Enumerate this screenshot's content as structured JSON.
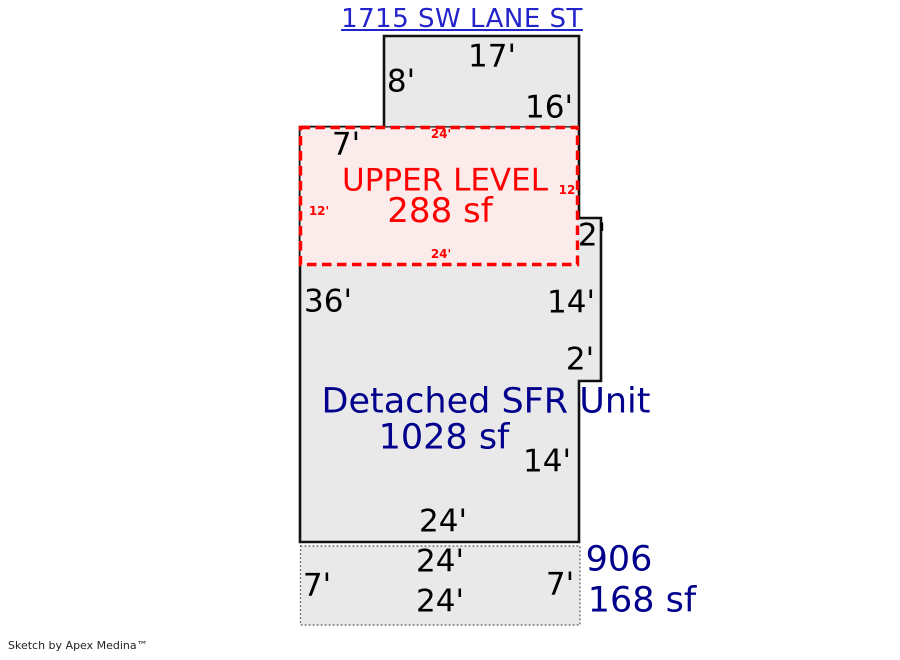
{
  "page": {
    "title": "1715 SW LANE ST",
    "credit": "Sketch by Apex Medina™"
  },
  "colors": {
    "address_blue": "#2323cc",
    "area_navy": "#00008c",
    "upper_red": "#ff0000",
    "dimension_black": "#000000",
    "building_fill": "#e9e9e9",
    "upper_fill": "#fcebeb"
  },
  "upper_level": {
    "label": "UPPER LEVEL",
    "area": "288 sf",
    "dim_top": "24'",
    "dim_bottom": "24'",
    "dim_left": "12'",
    "dim_right": "12"
  },
  "main_unit": {
    "label": "Detached SFR Unit",
    "area": "1028 sf",
    "dim_top": "17'",
    "dim_top_left": "8'",
    "dim_top_right": "16'",
    "dim_step_left": "7'",
    "dim_notch_out": "2'",
    "dim_left": "36'",
    "dim_right_upper": "14'",
    "dim_notch_in": "2'",
    "dim_right_lower": "14'",
    "dim_bottom": "24'"
  },
  "patio": {
    "number": "906",
    "area": "168 sf",
    "dim_top": "24'",
    "dim_left": "7'",
    "dim_right": "7'",
    "dim_bottom": "24'"
  }
}
